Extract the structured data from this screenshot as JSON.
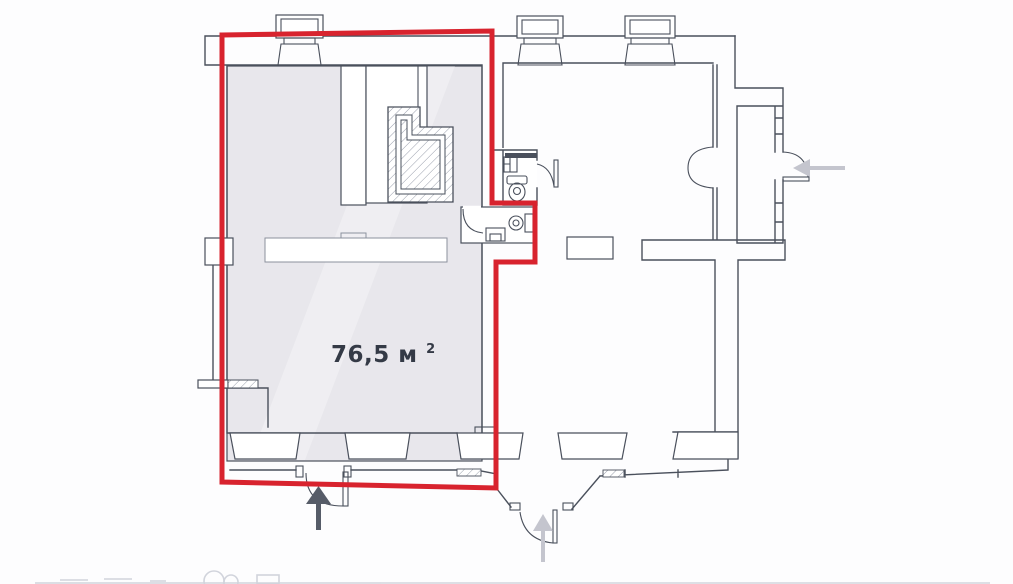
{
  "plan": {
    "type": "floor-plan",
    "highlighted_unit": {
      "area_text": "76,5 м",
      "area_superscript": "2",
      "area_full": "76,5 м²"
    },
    "colors": {
      "highlight_outline": "#d8232e",
      "unit_fill": "#e8e7ec",
      "wall": "#4a505c",
      "arrow_light": "#c4c5ce",
      "arrow_dark": "#565c68",
      "background": "#ffffff"
    },
    "icons": [
      {
        "name": "entrance-arrow-bottom-left",
        "direction": "up"
      },
      {
        "name": "entrance-arrow-bottom-right",
        "direction": "up"
      },
      {
        "name": "entrance-arrow-right",
        "direction": "left"
      }
    ],
    "features": [
      "chimney-stack-left",
      "chimney-stack-middle",
      "chimney-stack-right",
      "hatched-shaft",
      "upper-wc",
      "lower-wc",
      "storefront-windows",
      "entry-door-left-unit",
      "entry-door-right-unit",
      "entry-door-side",
      "double-door-interior",
      "partition-wall",
      "vestibule"
    ]
  }
}
